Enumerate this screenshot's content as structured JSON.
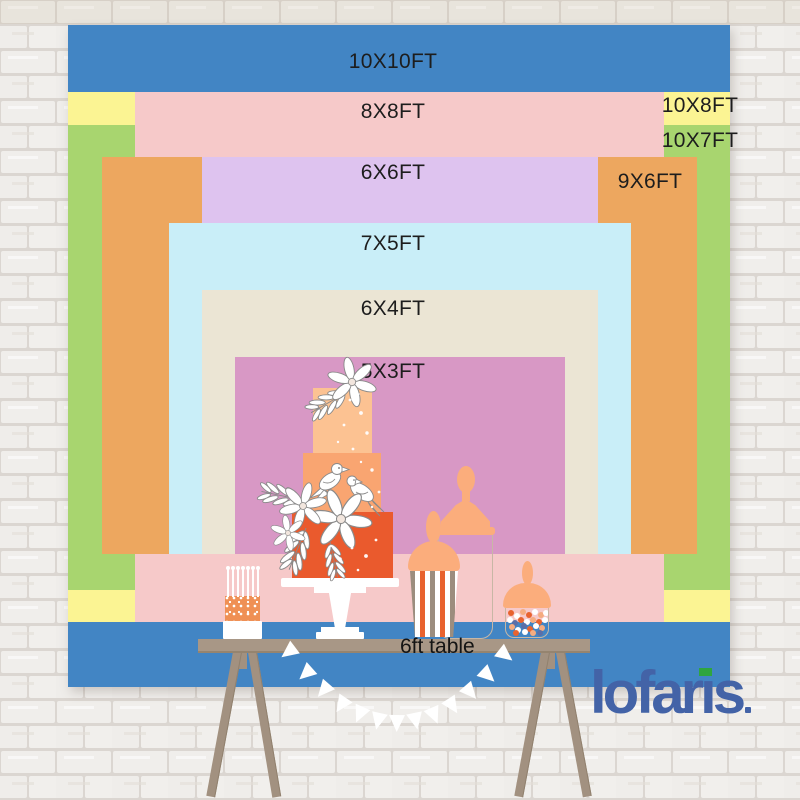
{
  "sizes": {
    "s10x10": {
      "label": "10X10FT",
      "color": "#4285C4"
    },
    "s8x8": {
      "label": "8X8FT",
      "color": "#F6C9C9"
    },
    "s10x8": {
      "label": "10X8FT",
      "color": "#FBF493"
    },
    "s10x7": {
      "label": "10X7FT",
      "color": "#A8D56F"
    },
    "s9x6": {
      "label": "9X6FT",
      "color": "#EDA75F"
    },
    "s6x6": {
      "label": "6X6FT",
      "color": "#DEC3EF"
    },
    "s7x5": {
      "label": "7X5FT",
      "color": "#C9EEF8"
    },
    "s6x4": {
      "label": "6X4FT",
      "color": "#EBE5D4"
    },
    "s5x3": {
      "label": "5X3FT",
      "color": "#D898C5"
    }
  },
  "table": {
    "label": "6ft table",
    "color": "#A89786"
  },
  "brand": {
    "logo_text": "lofaris",
    "logo_pre": "lofar",
    "logo_i": "ı",
    "logo_post": "s",
    "logo_color": "#4363A7",
    "logo_accent_color": "#2FA53F"
  }
}
